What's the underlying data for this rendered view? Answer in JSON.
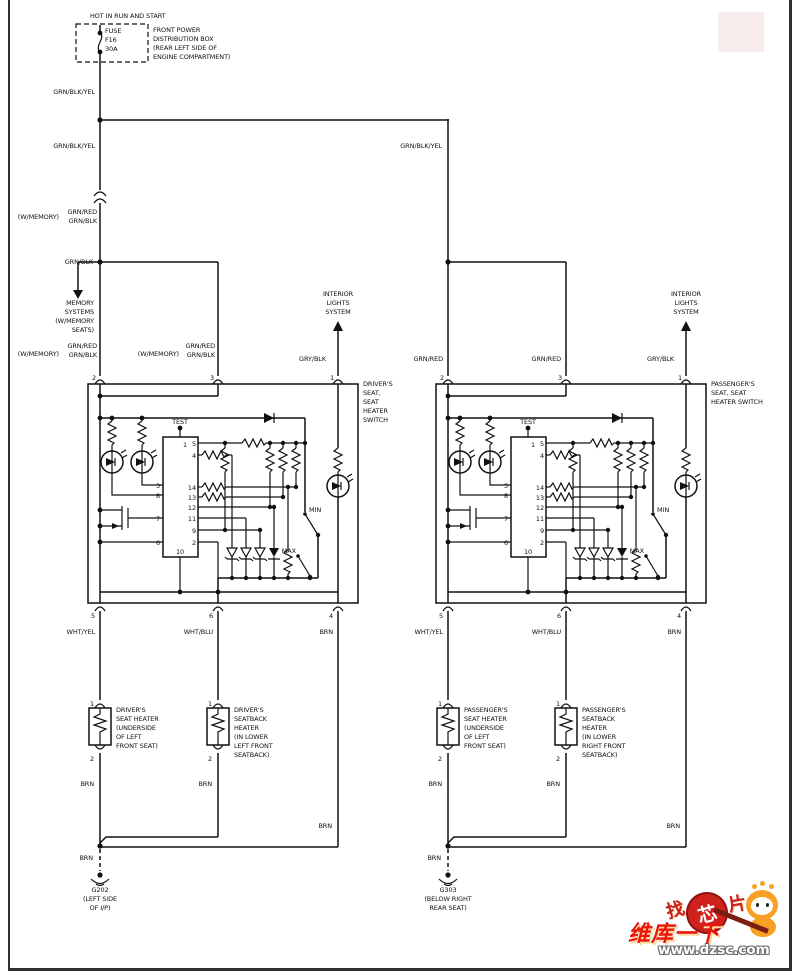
{
  "power": {
    "hot": "HOT IN RUN AND START",
    "fuse_name": "FUSE",
    "fuse_id": "F16",
    "fuse_rating": "30A",
    "dist_box": "FRONT POWER\nDISTRIBUTION BOX\n(REAR LEFT SIDE OF\nENGINE COMPARTMENT)"
  },
  "wires": {
    "grn_blk_yel": "GRN/BLK/YEL",
    "grn_red": "GRN/RED",
    "grn_red_blk": "GRN/RED\nGRN/BLK",
    "grn_blk": "GRN/BLK",
    "w_memory": "(W/MEMORY)",
    "gry_blk": "GRY/BLK",
    "wht_yel": "WHT/YEL",
    "wht_blu": "WHT/BLU",
    "brn": "BRN"
  },
  "notes": {
    "memory_systems": "MEMORY\nSYSTEMS\n(W/MEMORY\nSEATS)",
    "interior_lights": "INTERIOR\nLIGHTS\nSYSTEM"
  },
  "driver": {
    "switch": "DRIVER'S\nSEAT,\nSEAT\nHEATER\nSWITCH",
    "seat_heater": "DRIVER'S\nSEAT HEATER\n(UNDERSIDE\nOF LEFT\nFRONT SEAT)",
    "seatback_heater": "DRIVER'S\nSEATBACK\nHEATER\n(IN LOWER\nLEFT FRONT\nSEATBACK)",
    "ground": "G202\n(LEFT SIDE\nOF I/P)"
  },
  "passenger": {
    "switch": "PASSENGER'S\nSEAT, SEAT\nHEATER SWITCH",
    "seat_heater": "PASSENGER'S\nSEAT HEATER\n(UNDERSIDE\nOF LEFT\nFRONT SEAT)",
    "seatback_heater": "PASSENGER'S\nSEATBACK\nHEATER\n(IN LOWER\nRIGHT FRONT\nSEATBACK)",
    "ground": "G303\n(BELOW RIGHT\nREAR SEAT)"
  },
  "switch_internal": {
    "test": "TEST",
    "min": "MIN",
    "max": "MAX"
  },
  "pins": {
    "n1": "1",
    "n2": "2",
    "n3": "3",
    "n4": "4",
    "n5": "5",
    "n6": "6",
    "n7": "7",
    "n8": "8",
    "n9": "9",
    "n10": "10",
    "n11": "11",
    "n12": "12",
    "n13": "13",
    "n14": "14"
  },
  "watermark": {
    "zhao": "找",
    "xin": "芯",
    "pian": "片",
    "brand": "维库一下",
    "url": "www.dzsc.com"
  }
}
